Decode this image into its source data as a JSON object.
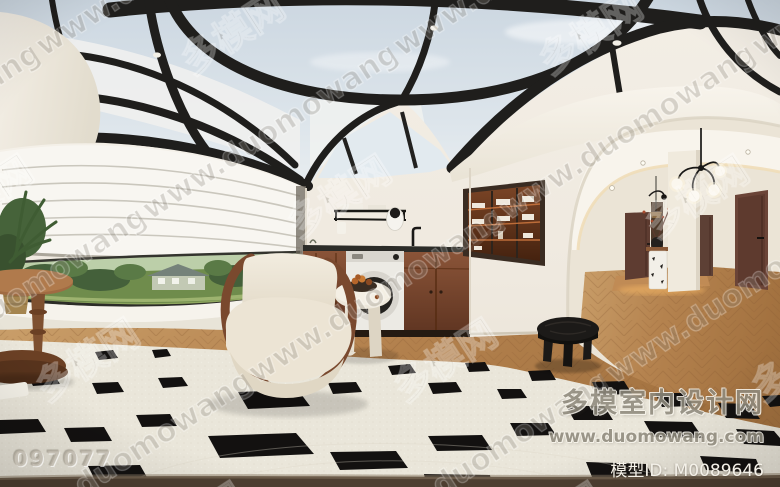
{
  "watermarks": {
    "tiled_url": "www.duomowang.com",
    "tiled_site_name": "多模网",
    "photo_id": "097077",
    "brand_name_cn": "多模室内设计网",
    "brand_url": "www.duomowang.com",
    "model_id": "模型ID: M0089646"
  },
  "palette": {
    "sky_glass": "#d7e0e8",
    "roof_beam_black": "#1f1e1c",
    "wall_cream": "#f0ebe2",
    "cove_white": "#f6f2ea",
    "cabinet_brown": "#7c4a31",
    "counter_black": "#2c2c28",
    "door_brown": "#634134",
    "wood_floor": "#b5834f",
    "rug_cream": "#eae6da",
    "rug_motif_black": "#131110",
    "garden_green": "#55713c",
    "armchair_boucle": "#ece4d4",
    "watermark_gray": "#8a857c"
  }
}
